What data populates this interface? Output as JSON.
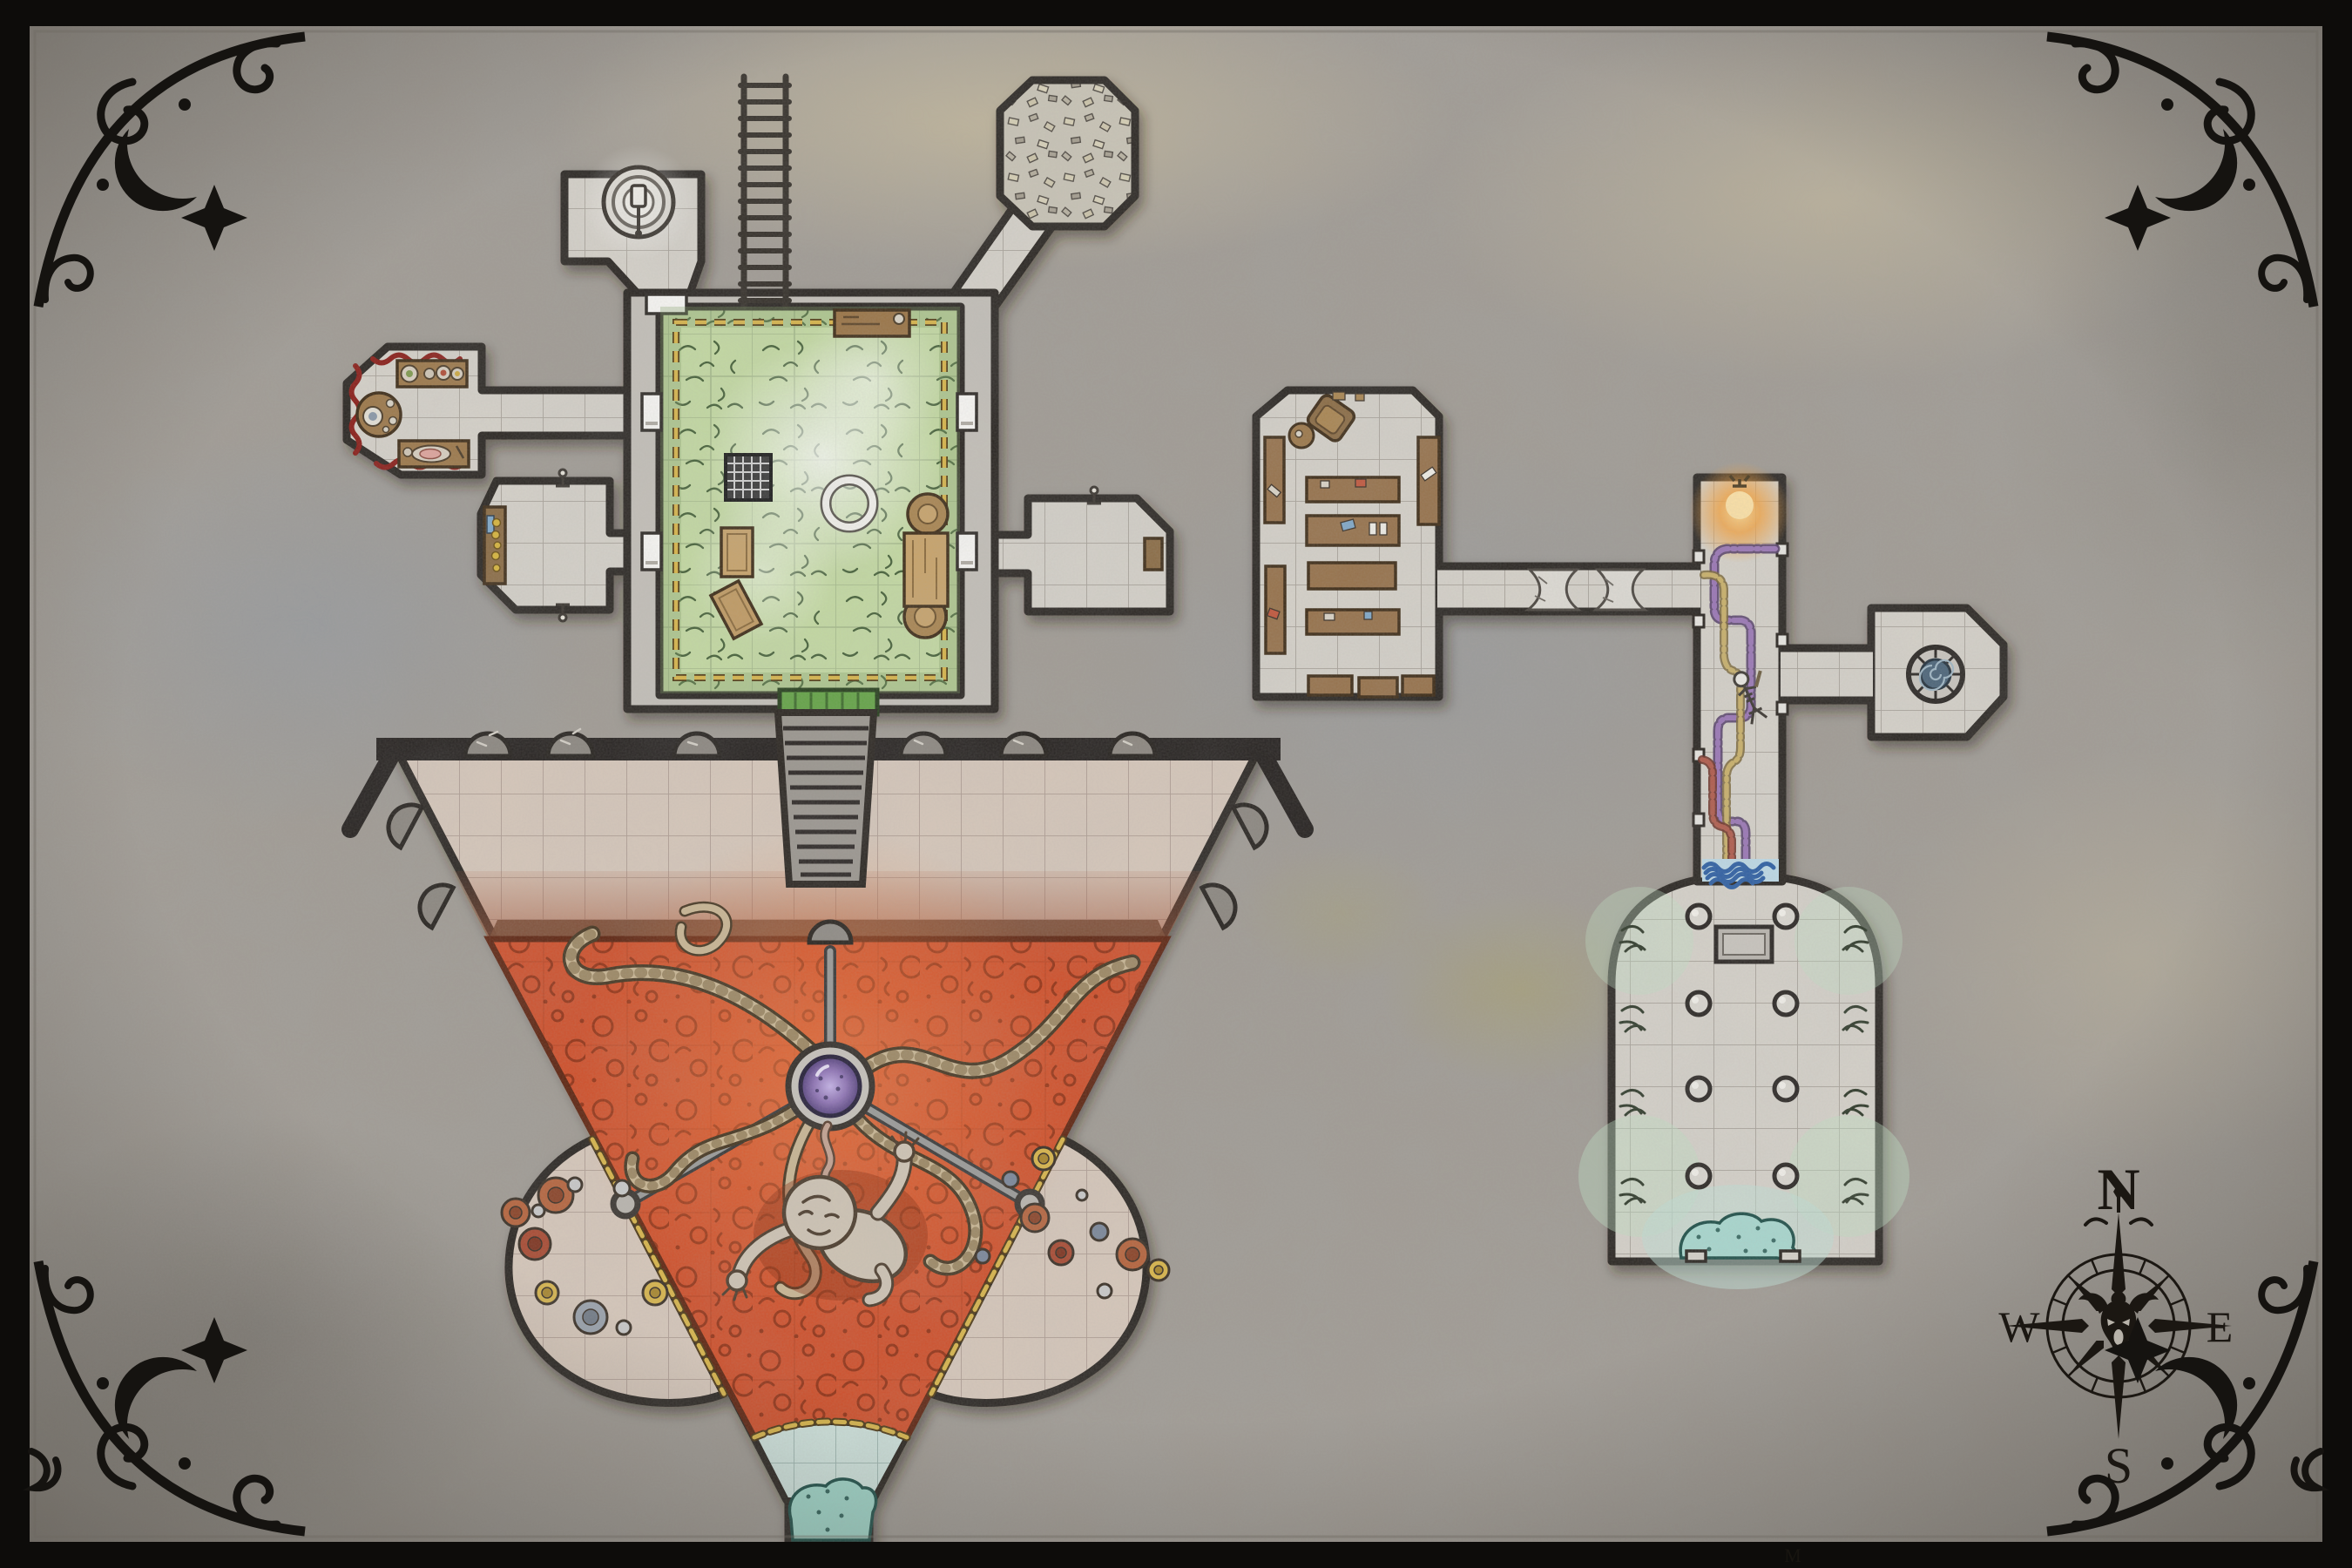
{
  "map": {
    "title": "hand-drawn dungeon battle map",
    "compass": {
      "north": "N",
      "east": "E",
      "south": "S",
      "west": "W"
    },
    "signature": "M",
    "palette": {
      "stone_background": "#a09b94",
      "room_floor": "#d5d1c9",
      "wall_ink": "#2a2520",
      "moss_green": "#c3d9a2",
      "lava_orange": "#cf4f2a",
      "water_teal": "#a8d8cf",
      "water_blue": "#2e5fa3",
      "chain_gold": "#d8b54a",
      "trail_purple": "#8f6aab",
      "trail_tan": "#c3aa66",
      "trail_red": "#a85545",
      "orb_purple": "#7b5fa0",
      "door_white": "#f7f6f3",
      "door_green": "#63a345",
      "decor_red": "#8a1d18",
      "border_ink": "#151310",
      "torch_glow": "#f6a23c"
    },
    "rooms": [
      {
        "id": "well-room",
        "name": "well room"
      },
      {
        "id": "ladder-shaft",
        "name": "ladder shaft"
      },
      {
        "id": "rubble-room",
        "name": "rubble-filled room"
      },
      {
        "id": "moss-garden-room",
        "name": "overgrown moss room"
      },
      {
        "id": "dining-room",
        "name": "dining room with red trim"
      },
      {
        "id": "sideboard-room",
        "name": "sideboard room"
      },
      {
        "id": "east-closet-room",
        "name": "east closet room"
      },
      {
        "id": "library-storeroom",
        "name": "library storeroom"
      },
      {
        "id": "cobweb-corridor",
        "name": "cobwebbed corridor"
      },
      {
        "id": "pipe-corridor",
        "name": "corridor with colored trails"
      },
      {
        "id": "pool-room",
        "name": "spiral pool room"
      },
      {
        "id": "dome-hall",
        "name": "domed pillared hall"
      },
      {
        "id": "funnel-chamber",
        "name": "funnel lava chamber"
      },
      {
        "id": "left-treasure-alcove",
        "name": "west treasure alcove"
      },
      {
        "id": "right-treasure-alcove",
        "name": "east treasure alcove"
      },
      {
        "id": "stair-passage",
        "name": "staircase passage"
      }
    ],
    "features": [
      "well with bucket",
      "long ladder",
      "rubble pile",
      "floor grate",
      "summoning ring",
      "bone niches",
      "lava pool with tentacles",
      "suspended purple orb",
      "floating embryonic creature",
      "treasure discs and coins",
      "skeleton with staff",
      "cobwebs",
      "glowing torch",
      "spiral well pool",
      "pillared dome with spring water",
      "compass rose with demon face"
    ]
  }
}
